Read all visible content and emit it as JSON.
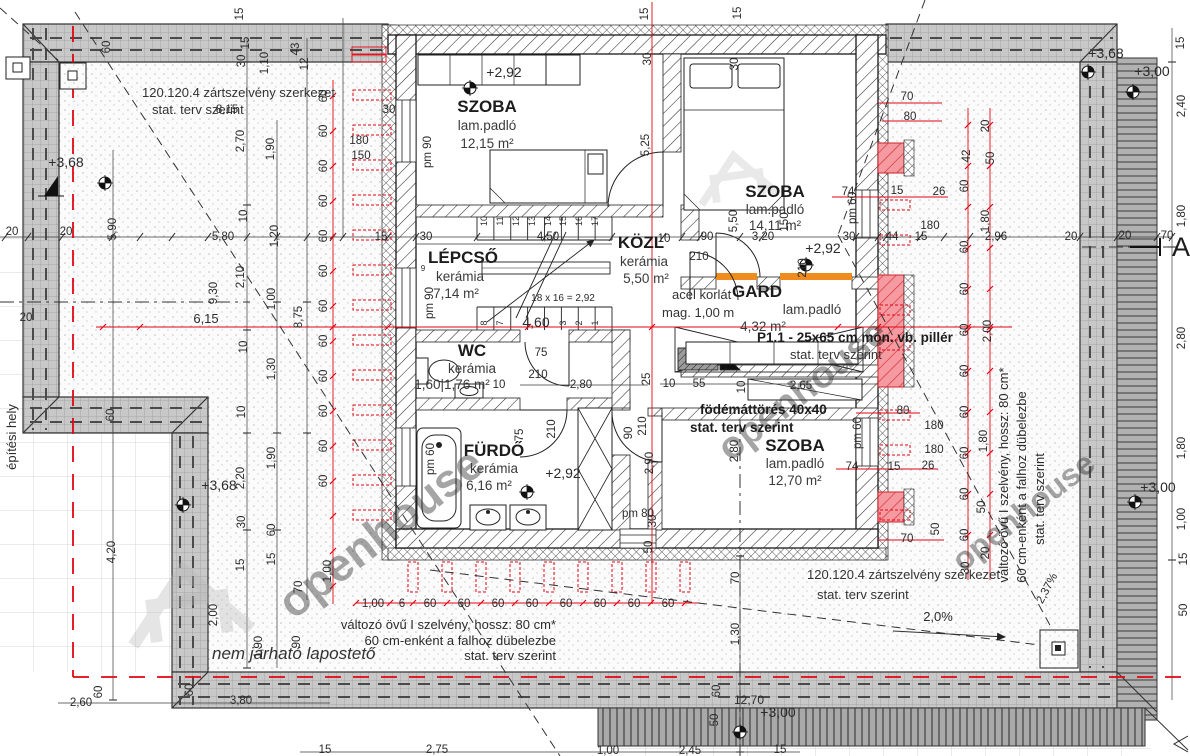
{
  "title": "floor-plan-drawing",
  "colors": {
    "red": "#e30613",
    "orange": "#f08c1e",
    "pillar": "#f59aa0",
    "band": "#c8c8c8",
    "watermark": "#c9c9c9",
    "ink": "#2b2b2b"
  },
  "rooms": {
    "szoba1": {
      "name": "SZOBA",
      "floor": "lam.padló",
      "area": "12,15 m²"
    },
    "szoba2": {
      "name": "SZOBA",
      "floor": "lam.padló",
      "area": "14,11 m²"
    },
    "lepcso": {
      "name": "LÉPCSŐ",
      "floor": "kerámia",
      "area": "7,14 m²"
    },
    "kozl": {
      "name": "KÖZL",
      "floor": "kerámia",
      "area": "5,50 m²"
    },
    "gard": {
      "name": "GARD",
      "floor": "lam.padló",
      "area": "4,32 m²"
    },
    "wc": {
      "name": "WC",
      "floor": "kerámia",
      "area": "1,60|1,76 m²"
    },
    "furdo": {
      "name": "FÜRDŐ",
      "floor": "kerámia",
      "area": "6,16 m²"
    },
    "szoba3": {
      "name": "SZOBA",
      "floor": "lam.padló",
      "area": "12,70 m²"
    }
  },
  "notes": {
    "frame_top": [
      "120.120.4 zártszelvény szerkezet",
      "stat. terv szerint"
    ],
    "frame_bottom": [
      "120.120.4 zártszelvény szerkezet",
      "stat. terv szerint"
    ],
    "railing": [
      "acél korlát",
      "mag. 1,00 m"
    ],
    "pillar": [
      "P1.1 - 25x65 cm mon. vb. pillér",
      "stat. terv szerint"
    ],
    "slab_opening": [
      "födémáttörés 40x40",
      "stat. terv szerint"
    ],
    "i_section": [
      "változó övű I szelvény, hossz: 80 cm*",
      "60 cm-enként a falhoz dübelezbe",
      "stat. terv szerint"
    ],
    "site_boundary": "építési hely",
    "flat_roof": "nem járható lapostető",
    "watermark": "openhouse",
    "section_mark": "A"
  },
  "dims": [
    {
      "t": "15",
      "x": 243,
      "y": 14,
      "r": -90
    },
    {
      "t": "15",
      "x": 648,
      "y": 14,
      "r": -90,
      "c": "r"
    },
    {
      "t": "15",
      "x": 741,
      "y": 13,
      "r": -90
    },
    {
      "t": "60",
      "x": 110,
      "y": 47,
      "r": -90
    },
    {
      "t": "15",
      "x": 249,
      "y": 43,
      "r": -90
    },
    {
      "t": "30",
      "x": 245,
      "y": 61,
      "r": -90
    },
    {
      "t": "1,10",
      "x": 268,
      "y": 63,
      "r": -90
    },
    {
      "t": "43",
      "x": 299,
      "y": 49,
      "r": -90
    },
    {
      "t": "12",
      "x": 308,
      "y": 64,
      "r": -90
    },
    {
      "t": "30",
      "x": 651,
      "y": 59,
      "r": -90,
      "c": "r"
    },
    {
      "t": "30",
      "x": 738,
      "y": 64,
      "r": -90
    },
    {
      "t": "8,15",
      "x": 227,
      "y": 113
    },
    {
      "t": "+3,68",
      "x": 66,
      "y": 167,
      "s": 14
    },
    {
      "t": "+2,92",
      "x": 504,
      "y": 77,
      "s": 14
    },
    {
      "t": "5,25",
      "x": 649,
      "y": 145,
      "r": -90,
      "c": "r"
    },
    {
      "t": "2,70",
      "x": 244,
      "y": 141,
      "r": -90
    },
    {
      "t": "1,90",
      "x": 274,
      "y": 149,
      "r": -90
    },
    {
      "t": "pm 90",
      "x": 431,
      "y": 152,
      "r": -90
    },
    {
      "t": "180",
      "x": 359,
      "y": 144
    },
    {
      "t": "150",
      "x": 361,
      "y": 159
    },
    {
      "t": "30",
      "x": 389,
      "y": 113
    },
    {
      "t": "10",
      "x": 247,
      "y": 216,
      "r": -90
    },
    {
      "t": "1,20",
      "x": 278,
      "y": 236,
      "r": -90
    },
    {
      "t": "+3,68",
      "x": 1106,
      "y": 58,
      "s": 14
    },
    {
      "t": "+3,00",
      "x": 1152,
      "y": 76,
      "s": 14
    },
    {
      "t": "15",
      "x": 1184,
      "y": 43,
      "r": -90
    },
    {
      "t": "2,40",
      "x": 1185,
      "y": 106,
      "r": -90
    },
    {
      "t": "20",
      "x": 12,
      "y": 235
    },
    {
      "t": "20",
      "x": 66,
      "y": 235
    },
    {
      "t": "5,90",
      "x": 116,
      "y": 229,
      "r": -90
    },
    {
      "t": "5,80",
      "x": 223,
      "y": 240
    },
    {
      "t": "15",
      "x": 381,
      "y": 240
    },
    {
      "t": "30",
      "x": 426,
      "y": 240
    },
    {
      "t": "4,50",
      "x": 548,
      "y": 240
    },
    {
      "t": "10",
      "x": 664,
      "y": 242
    },
    {
      "t": "90",
      "x": 707,
      "y": 240
    },
    {
      "t": "210",
      "x": 699,
      "y": 260
    },
    {
      "t": "3,20",
      "x": 763,
      "y": 240
    },
    {
      "t": "30",
      "x": 849,
      "y": 240
    },
    {
      "t": "44",
      "x": 892,
      "y": 240
    },
    {
      "t": "15",
      "x": 921,
      "y": 240
    },
    {
      "t": "180",
      "x": 930,
      "y": 229
    },
    {
      "t": "2,96",
      "x": 996,
      "y": 240
    },
    {
      "t": "20",
      "x": 1071,
      "y": 240
    },
    {
      "t": "20",
      "x": 1125,
      "y": 239
    },
    {
      "t": "70",
      "x": 1167,
      "y": 239
    },
    {
      "t": "9,30",
      "x": 217,
      "y": 293,
      "r": -90
    },
    {
      "t": "2,10",
      "x": 244,
      "y": 277,
      "r": -90
    },
    {
      "t": "1,00",
      "x": 275,
      "y": 299,
      "r": -90
    },
    {
      "t": "8,75",
      "x": 302,
      "y": 317,
      "r": -90
    },
    {
      "t": "6,15",
      "x": 206,
      "y": 323,
      "c": "r",
      "s": 13
    },
    {
      "t": "20",
      "x": 26,
      "y": 321,
      "c": "r"
    },
    {
      "t": "10",
      "x": 247,
      "y": 347,
      "r": -90
    },
    {
      "t": "1,30",
      "x": 275,
      "y": 369,
      "r": -90
    },
    {
      "t": "10",
      "x": 245,
      "y": 412,
      "r": -90
    },
    {
      "t": "1,90",
      "x": 275,
      "y": 458,
      "r": -90
    },
    {
      "t": "2,20",
      "x": 244,
      "y": 478,
      "r": -90
    },
    {
      "t": "4,20",
      "x": 115,
      "y": 552,
      "r": -90
    },
    {
      "t": "30",
      "x": 245,
      "y": 522,
      "r": -90
    },
    {
      "t": "60",
      "x": 275,
      "y": 530,
      "r": -90
    },
    {
      "t": "15",
      "x": 244,
      "y": 565,
      "r": -90
    },
    {
      "t": "15",
      "x": 275,
      "y": 559,
      "r": -90
    },
    {
      "t": "70",
      "x": 302,
      "y": 587,
      "r": -90
    },
    {
      "t": "2,00",
      "x": 217,
      "y": 615,
      "r": -90
    },
    {
      "t": "90",
      "x": 300,
      "y": 642,
      "r": -90
    },
    {
      "t": "60",
      "x": 114,
      "y": 415,
      "r": -90
    },
    {
      "t": "+3,68",
      "x": 219,
      "y": 490,
      "s": 14
    },
    {
      "t": "60",
      "x": 327,
      "y": 96,
      "r": -90,
      "c": "r"
    },
    {
      "t": "60",
      "x": 327,
      "y": 131,
      "r": -90,
      "c": "r"
    },
    {
      "t": "60",
      "x": 327,
      "y": 166,
      "r": -90,
      "c": "r"
    },
    {
      "t": "60",
      "x": 327,
      "y": 201,
      "r": -90,
      "c": "r"
    },
    {
      "t": "60",
      "x": 327,
      "y": 236,
      "r": -90,
      "c": "r"
    },
    {
      "t": "60",
      "x": 327,
      "y": 271,
      "r": -90,
      "c": "r"
    },
    {
      "t": "60",
      "x": 327,
      "y": 306,
      "r": -90,
      "c": "r"
    },
    {
      "t": "60",
      "x": 327,
      "y": 341,
      "r": -90,
      "c": "r"
    },
    {
      "t": "60",
      "x": 327,
      "y": 376,
      "r": -90,
      "c": "r"
    },
    {
      "t": "60",
      "x": 327,
      "y": 411,
      "r": -90,
      "c": "r"
    },
    {
      "t": "60",
      "x": 327,
      "y": 446,
      "r": -90,
      "c": "r"
    },
    {
      "t": "60",
      "x": 327,
      "y": 481,
      "r": -90,
      "c": "r"
    },
    {
      "t": "1,00",
      "x": 331,
      "y": 571,
      "r": -90,
      "c": "r"
    },
    {
      "t": "1,00",
      "x": 373,
      "y": 607,
      "c": "r"
    },
    {
      "t": "6",
      "x": 402,
      "y": 607,
      "c": "r"
    },
    {
      "t": "60",
      "x": 430,
      "y": 607,
      "c": "r"
    },
    {
      "t": "60",
      "x": 464,
      "y": 607,
      "c": "r"
    },
    {
      "t": "60",
      "x": 498,
      "y": 607,
      "c": "r"
    },
    {
      "t": "60",
      "x": 532,
      "y": 607,
      "c": "r"
    },
    {
      "t": "60",
      "x": 566,
      "y": 607,
      "c": "r"
    },
    {
      "t": "60",
      "x": 600,
      "y": 607,
      "c": "r"
    },
    {
      "t": "60",
      "x": 634,
      "y": 607,
      "c": "r"
    },
    {
      "t": "60",
      "x": 668,
      "y": 607,
      "c": "r"
    },
    {
      "t": "25",
      "x": 650,
      "y": 379,
      "r": -90,
      "c": "r"
    },
    {
      "t": "2,90",
      "x": 653,
      "y": 463,
      "r": -90,
      "c": "r"
    },
    {
      "t": "30",
      "x": 656,
      "y": 521,
      "r": -90,
      "c": "r"
    },
    {
      "t": "210",
      "x": 646,
      "y": 426,
      "r": -90
    },
    {
      "t": "50",
      "x": 652,
      "y": 547,
      "r": -90,
      "c": "r"
    },
    {
      "t": "10",
      "x": 487,
      "y": 221,
      "r": -90,
      "s": 9
    },
    {
      "t": "11",
      "x": 503,
      "y": 221,
      "r": -90,
      "s": 9
    },
    {
      "t": "12",
      "x": 519,
      "y": 221,
      "r": -90,
      "s": 9
    },
    {
      "t": "13",
      "x": 535,
      "y": 221,
      "r": -90,
      "s": 9
    },
    {
      "t": "14",
      "x": 551,
      "y": 221,
      "r": -90,
      "s": 9
    },
    {
      "t": "15",
      "x": 566,
      "y": 221,
      "r": -90,
      "s": 9
    },
    {
      "t": "16",
      "x": 582,
      "y": 221,
      "r": -90,
      "s": 9
    },
    {
      "t": "17",
      "x": 598,
      "y": 221,
      "r": -90,
      "s": 9
    },
    {
      "t": "8",
      "x": 487,
      "y": 323,
      "r": -90,
      "s": 9
    },
    {
      "t": "7",
      "x": 503,
      "y": 323,
      "r": -90,
      "s": 9
    },
    {
      "t": "3",
      "x": 566,
      "y": 323,
      "r": -90,
      "s": 9
    },
    {
      "t": "2",
      "x": 582,
      "y": 323,
      "r": -90,
      "s": 9
    },
    {
      "t": "1",
      "x": 598,
      "y": 323,
      "r": -90,
      "s": 9
    },
    {
      "t": "4,60",
      "x": 536,
      "y": 327,
      "c": "r",
      "s": 14
    },
    {
      "t": "18 x 16 = 2,92",
      "x": 563,
      "y": 301,
      "s": 10
    },
    {
      "t": "9",
      "x": 423,
      "y": 271,
      "s": 8
    },
    {
      "t": "pm 90",
      "x": 433,
      "y": 303,
      "r": -90
    },
    {
      "t": "75",
      "x": 541,
      "y": 356
    },
    {
      "t": "210",
      "x": 538,
      "y": 378
    },
    {
      "t": "10",
      "x": 499,
      "y": 388
    },
    {
      "t": "2,80",
      "x": 581,
      "y": 388
    },
    {
      "t": "75",
      "x": 523,
      "y": 435,
      "r": -90
    },
    {
      "t": "210",
      "x": 555,
      "y": 429,
      "r": -90
    },
    {
      "t": "90",
      "x": 632,
      "y": 433,
      "r": -90
    },
    {
      "t": "pm 60",
      "x": 434,
      "y": 459,
      "r": -90
    },
    {
      "t": "+2,92",
      "x": 563,
      "y": 478,
      "s": 14
    },
    {
      "t": "pm 80",
      "x": 638,
      "y": 517
    },
    {
      "t": "10",
      "x": 669,
      "y": 387
    },
    {
      "t": "55",
      "x": 699,
      "y": 387
    },
    {
      "t": "10",
      "x": 745,
      "y": 387,
      "r": -90
    },
    {
      "t": "2,65",
      "x": 801,
      "y": 389
    },
    {
      "t": "2,80",
      "x": 738,
      "y": 451,
      "r": -90
    },
    {
      "t": "pm 60",
      "x": 861,
      "y": 433,
      "r": -90
    },
    {
      "t": "+2,92",
      "x": 823,
      "y": 253,
      "s": 14
    },
    {
      "t": "150",
      "x": 788,
      "y": 222,
      "r": -90
    },
    {
      "t": "210",
      "x": 806,
      "y": 268,
      "r": -90
    },
    {
      "t": "5,50",
      "x": 737,
      "y": 221,
      "r": -90
    },
    {
      "t": "pm 60",
      "x": 856,
      "y": 208,
      "r": -90
    },
    {
      "t": "70",
      "x": 907,
      "y": 100,
      "c": "r"
    },
    {
      "t": "80",
      "x": 910,
      "y": 120,
      "c": "r"
    },
    {
      "t": "74",
      "x": 848,
      "y": 195,
      "c": "r"
    },
    {
      "t": "15",
      "x": 897,
      "y": 194,
      "c": "r"
    },
    {
      "t": "26",
      "x": 939,
      "y": 195,
      "c": "r"
    },
    {
      "t": "74",
      "x": 852,
      "y": 470,
      "c": "r"
    },
    {
      "t": "15",
      "x": 894,
      "y": 470,
      "c": "r"
    },
    {
      "t": "26",
      "x": 928,
      "y": 469,
      "c": "r"
    },
    {
      "t": "80",
      "x": 903,
      "y": 414,
      "c": "r"
    },
    {
      "t": "70",
      "x": 907,
      "y": 542,
      "c": "r"
    },
    {
      "t": "50",
      "x": 939,
      "y": 529,
      "r": -90,
      "c": "r"
    },
    {
      "t": "180",
      "x": 934,
      "y": 429
    },
    {
      "t": "180",
      "x": 934,
      "y": 453
    },
    {
      "t": "20",
      "x": 989,
      "y": 126,
      "r": -90,
      "c": "r"
    },
    {
      "t": "50",
      "x": 994,
      "y": 158,
      "r": -90,
      "c": "r"
    },
    {
      "t": "42",
      "x": 970,
      "y": 156,
      "r": -90,
      "c": "r"
    },
    {
      "t": "60",
      "x": 968,
      "y": 186,
      "r": -90,
      "c": "r"
    },
    {
      "t": "1,80",
      "x": 989,
      "y": 221,
      "r": -90,
      "c": "r"
    },
    {
      "t": "60",
      "x": 968,
      "y": 247,
      "r": -90,
      "c": "r"
    },
    {
      "t": "60",
      "x": 968,
      "y": 289,
      "r": -90,
      "c": "r"
    },
    {
      "t": "60",
      "x": 968,
      "y": 330,
      "r": -90,
      "c": "r"
    },
    {
      "t": "60",
      "x": 968,
      "y": 371,
      "r": -90,
      "c": "r"
    },
    {
      "t": "60",
      "x": 968,
      "y": 412,
      "r": -90,
      "c": "r"
    },
    {
      "t": "60",
      "x": 968,
      "y": 453,
      "r": -90,
      "c": "r"
    },
    {
      "t": "60",
      "x": 968,
      "y": 494,
      "r": -90,
      "c": "r"
    },
    {
      "t": "60",
      "x": 968,
      "y": 535,
      "r": -90,
      "c": "r"
    },
    {
      "t": "2,00",
      "x": 991,
      "y": 331,
      "r": -90,
      "c": "r"
    },
    {
      "t": "1,80",
      "x": 987,
      "y": 441,
      "r": -90,
      "c": "r"
    },
    {
      "t": "50",
      "x": 985,
      "y": 507,
      "r": -90,
      "c": "r"
    },
    {
      "t": "30",
      "x": 969,
      "y": 568,
      "r": -90,
      "c": "r"
    },
    {
      "t": "20",
      "x": 989,
      "y": 553,
      "r": -90,
      "c": "r"
    },
    {
      "t": "1,80",
      "x": 1185,
      "y": 216,
      "r": -90
    },
    {
      "t": "2,80",
      "x": 1185,
      "y": 338,
      "r": -90
    },
    {
      "t": "1,80",
      "x": 1185,
      "y": 448,
      "r": -90
    },
    {
      "t": "+3,00",
      "x": 1158,
      "y": 492,
      "s": 14
    },
    {
      "t": "1,00",
      "x": 1185,
      "y": 519,
      "r": -90
    },
    {
      "t": "15",
      "x": 1187,
      "y": 559,
      "r": -90
    },
    {
      "t": "50",
      "x": 1187,
      "y": 610,
      "r": -90
    },
    {
      "t": "2,37%",
      "x": 1050,
      "y": 590,
      "r": -62
    },
    {
      "t": "2,0%",
      "x": 938,
      "y": 621,
      "s": 13
    },
    {
      "t": "70",
      "x": 739,
      "y": 578,
      "r": -90
    },
    {
      "t": "1,30",
      "x": 739,
      "y": 634,
      "r": -90
    },
    {
      "t": "60",
      "x": 720,
      "y": 691,
      "r": -90
    },
    {
      "t": "12,70",
      "x": 749,
      "y": 704,
      "s": 12
    },
    {
      "t": "50",
      "x": 718,
      "y": 720,
      "r": -90
    },
    {
      "t": "+3,00",
      "x": 778,
      "y": 717,
      "s": 14
    },
    {
      "t": "2,60",
      "x": 81,
      "y": 706
    },
    {
      "t": "60",
      "x": 102,
      "y": 692,
      "r": -90
    },
    {
      "t": "3,80",
      "x": 241,
      "y": 704
    },
    {
      "t": "60",
      "x": 193,
      "y": 690,
      "r": -90
    },
    {
      "t": "1,90",
      "x": 262,
      "y": 647,
      "r": -90
    },
    {
      "t": "15",
      "x": 325,
      "y": 753
    },
    {
      "t": "2,75",
      "x": 437,
      "y": 753
    },
    {
      "t": "1,00",
      "x": 608,
      "y": 754
    },
    {
      "t": "2,45",
      "x": 690,
      "y": 754
    },
    {
      "t": "15",
      "x": 780,
      "y": 753
    }
  ]
}
